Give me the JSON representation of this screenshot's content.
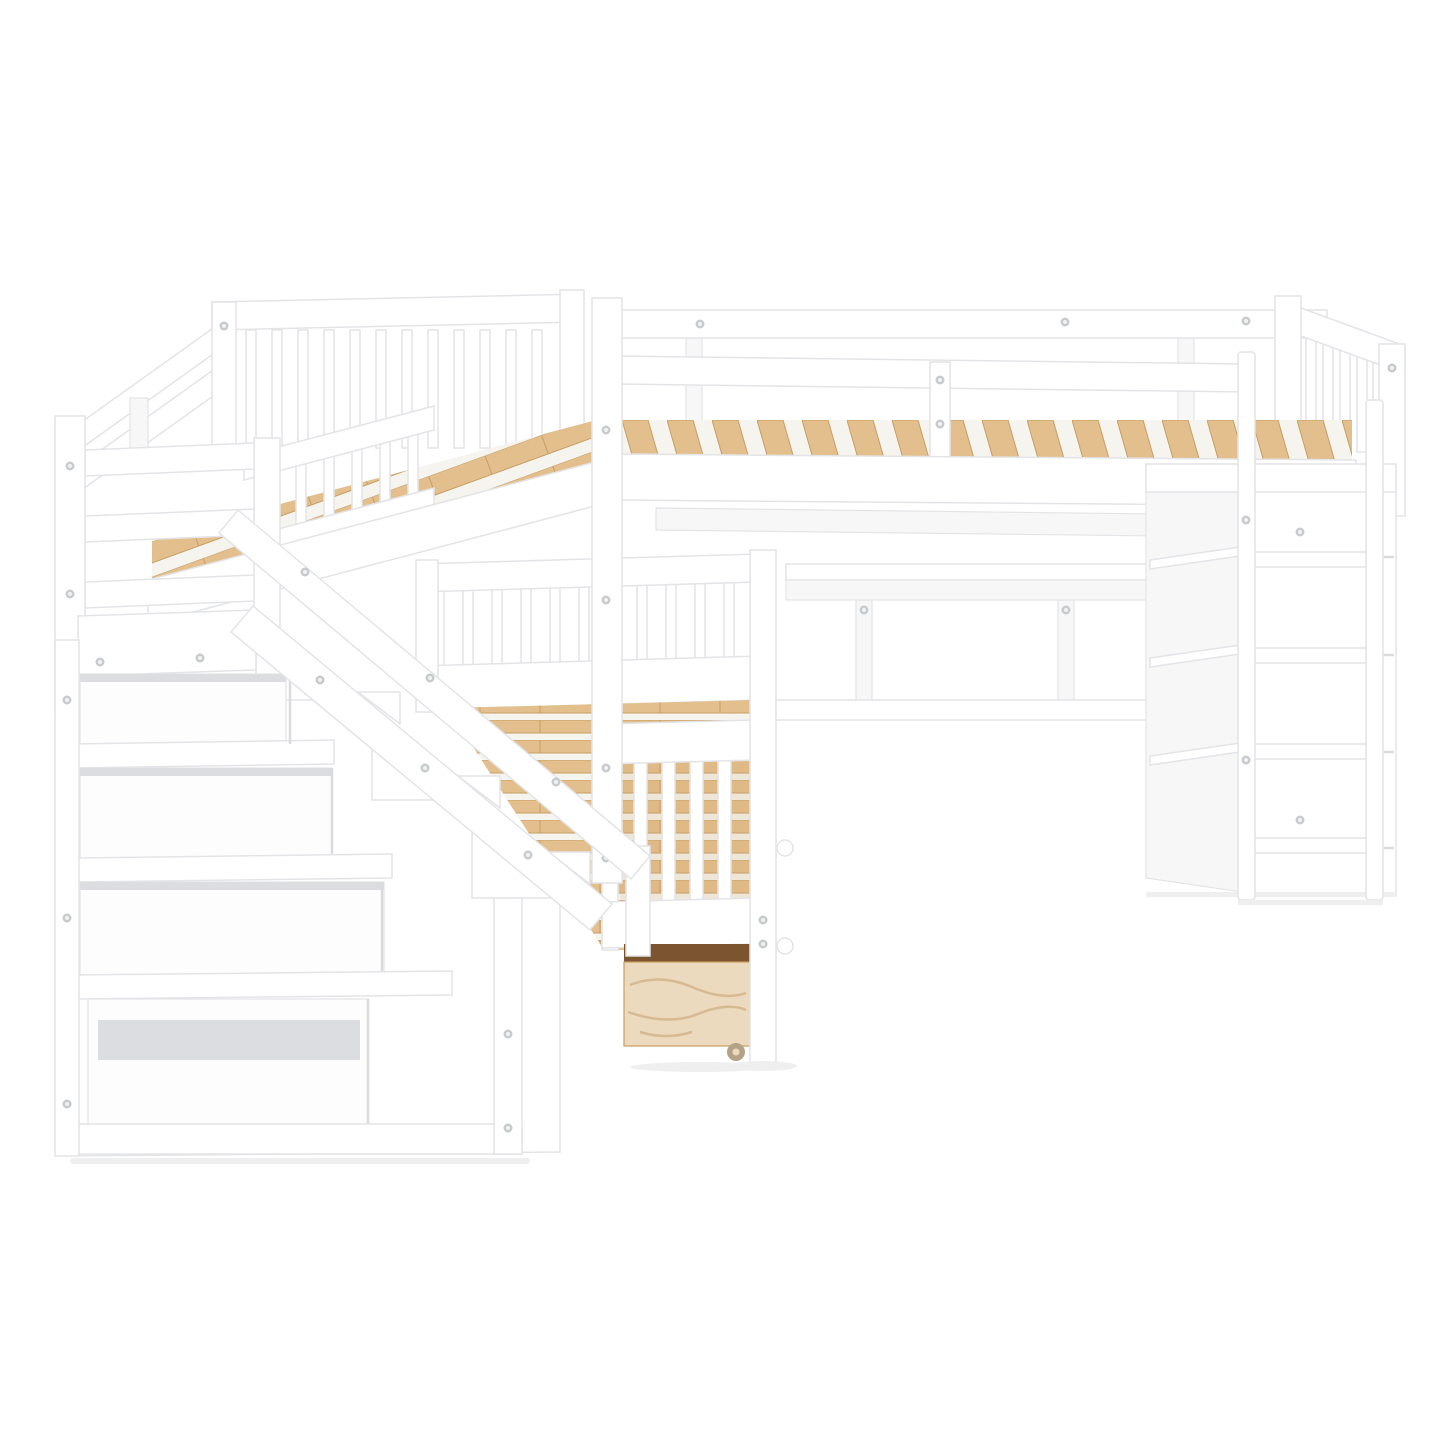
{
  "scene": {
    "description": "Product photo of a white wooden L-shaped twin-over-twin bunk bed system on a plain white background: two upper loft beds joined at a corner with spindle guardrails and exposed natural wood slats, a storage staircase with open shelves on the left, a lower twin bed with a rolling plywood storage drawer in the middle, and a loft workstation on the right with a desk, a shelf cabinet and a vertical ladder.",
    "background": "#ffffff"
  },
  "objects": {
    "right_loft_bed": {
      "label": "right loft bed",
      "description": "Upper twin loft bed with long white guardrails, natural wood slats and a spindle headboard at the right end"
    },
    "upper_left_bed": {
      "label": "upper left bed",
      "description": "Second upper twin bed set at a right angle, with spindle headboard, angled guardrails and exposed wood slats"
    },
    "lower_bed": {
      "label": "lower bed",
      "description": "Lower twin bed with natural wood slats and a white spindle footboard"
    },
    "storage_drawer": {
      "label": "storage drawer",
      "description": "Rolling under-bed storage drawer with natural plywood front and caster wheel"
    },
    "staircase": {
      "label": "storage staircase",
      "description": "White staircase with built-in open storage shelves and a diagonal handrail"
    },
    "desk": {
      "label": "desk",
      "description": "Built-in white desk under the right loft bed"
    },
    "cabinet": {
      "label": "shelf cabinet",
      "description": "Tall white side cabinet with shelves supporting the right loft bed"
    },
    "ladder": {
      "label": "ladder",
      "description": "Vertical white ladder with four rungs leaning on the cabinet"
    }
  },
  "colors": {
    "background": "#ffffff",
    "frame_white": "#ffffff",
    "frame_shade": "#f7f7f8",
    "outline": "#e3e4e7",
    "edge_shadow": "#dadbde",
    "inner_shadow": "#dcdde0",
    "opening_fill": "#fdfdfd",
    "deck_backing": "#f6f4ef",
    "wood": "#e3bf8e",
    "wood_light": "#edd6ae",
    "wood_dark": "#cfa46b",
    "wood_edge": "#c79e63",
    "gap_dark": "#7c5530",
    "plywood": "#ebdabd",
    "plywood_grain": "#d2b187",
    "screw": "#c8cbce",
    "screw_center": "#f1f2f3",
    "caster": "#b3a286",
    "floor_shadow": "#efeff0"
  }
}
